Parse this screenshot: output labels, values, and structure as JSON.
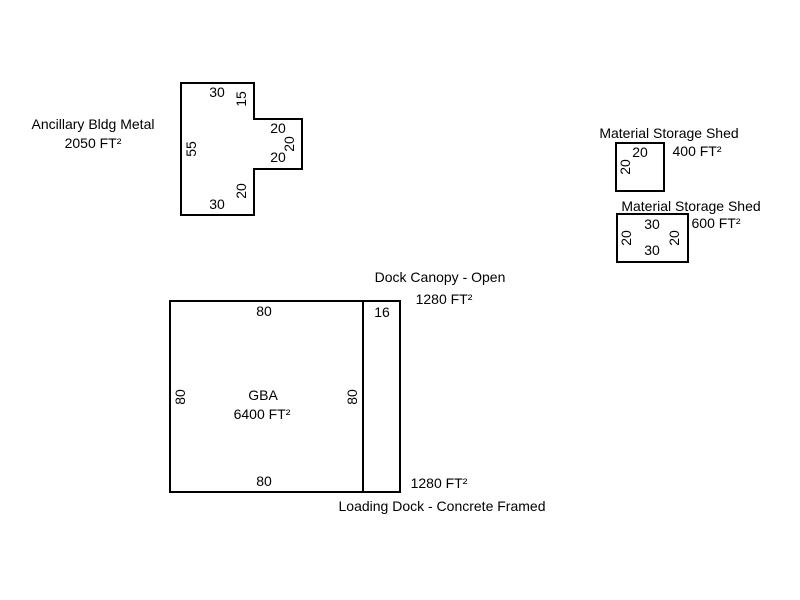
{
  "canvas": {
    "background_color": "#ffffff",
    "line_color": "#000000",
    "text_color": "#000000"
  },
  "buildings": {
    "ancillary": {
      "name": "Ancillary Bldg Metal",
      "area": "2050 FT²",
      "dims": {
        "top": "30",
        "right_upper": "15",
        "notch_top": "20",
        "notch_right": "20",
        "notch_bottom": "20",
        "left": "55",
        "right_lower": "20",
        "bottom": "30"
      }
    },
    "shed_400": {
      "name": "Material Storage Shed",
      "area": "400 FT²",
      "dims": {
        "top": "20",
        "left": "20"
      }
    },
    "shed_600": {
      "name": "Material Storage Shed",
      "area": "600 FT²",
      "dims": {
        "top": "30",
        "left": "20",
        "right": "20",
        "bottom": "30"
      }
    },
    "gba": {
      "name": "GBA",
      "area": "6400 FT²",
      "dims": {
        "top": "80",
        "left": "80",
        "right": "80",
        "bottom": "80"
      }
    },
    "dock_canopy": {
      "name": "Dock Canopy - Open",
      "area": "1280 FT²",
      "dims": {
        "width": "16"
      }
    },
    "loading_dock": {
      "name": "Loading Dock - Concrete Framed",
      "area": "1280 FT²"
    }
  }
}
